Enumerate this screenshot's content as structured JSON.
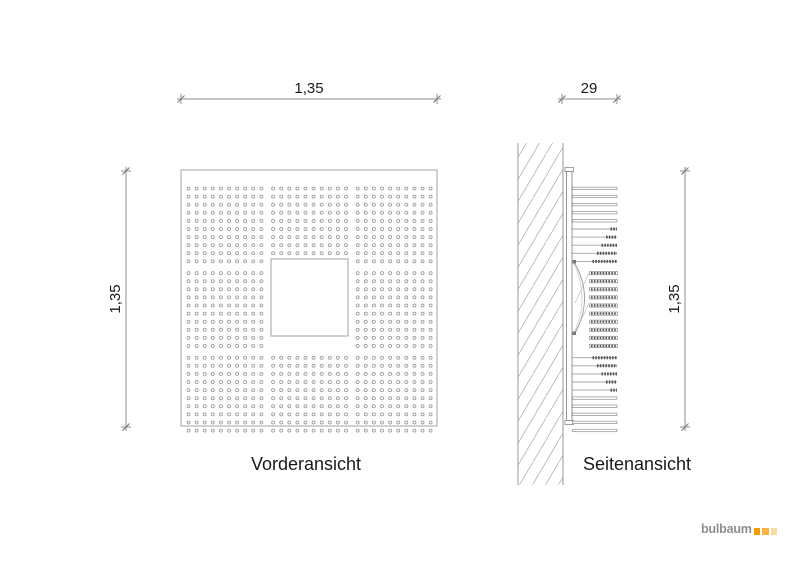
{
  "labels": {
    "front_view": "Vorderansicht",
    "side_view": "Seitenansicht"
  },
  "dimensions": {
    "front_width": "1,35",
    "front_height": "1,35",
    "side_depth": "29",
    "side_height": "1,35"
  },
  "logo": {
    "text": "bulbaum",
    "square_colors": [
      "#f29b00",
      "#f6b545",
      "#fadda4"
    ]
  },
  "front_panel": {
    "hole_grid": {
      "block_rows": 3,
      "block_cols": 3,
      "holes_per_block_row": 10,
      "holes_per_block_col": 10,
      "center_block": "square-cutout",
      "total_holes": 800
    }
  },
  "side_panel": {
    "slat_count": 30,
    "slat_rows_plain": [
      [
        0,
        4
      ],
      [
        25,
        29
      ]
    ],
    "slat_rows_dash_end": [
      [
        5,
        9
      ],
      [
        20,
        24
      ]
    ],
    "slat_rows_recessed": [
      [
        10,
        19
      ]
    ]
  },
  "colors": {
    "line": "#8f8f8f",
    "line_light": "#a3a3a3",
    "line_dark": "#555555",
    "hatch": "#b8b8b8",
    "text": "#1a1a1a",
    "logo_text": "#8d8d8d"
  }
}
